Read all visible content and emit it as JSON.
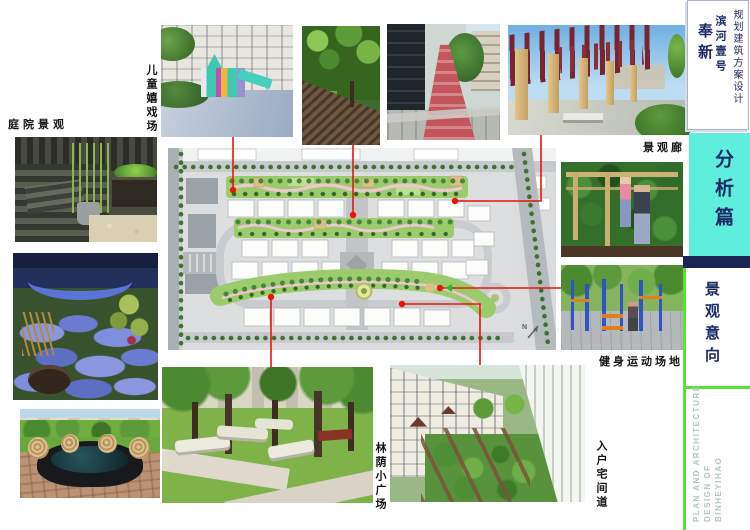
{
  "title_block": {
    "region": "奉新",
    "project": "滨河壹号",
    "doc_type": "规划建筑方案设计"
  },
  "section_tab": {
    "label": "分析篇"
  },
  "section_heading": {
    "label": "景观意向"
  },
  "footer": {
    "lines": [
      "PLAN AND ARCHITECTURE",
      "DESIGN OF",
      "BINHEYIHAO"
    ]
  },
  "photo_labels": {
    "courtyard": "庭院景观",
    "children_play": "儿童嬉戏场",
    "gallery": "景观廊",
    "fitness": "健身运动场地",
    "shaded_plaza": "林荫小广场",
    "entry_path": "入户宅间道"
  },
  "site_plan": {
    "compass": "N"
  },
  "colors": {
    "accent_cyan": "#5FEEDB",
    "accent_green": "#55E430",
    "navy": "#1C2A66",
    "connector_red": "#E8150C"
  }
}
